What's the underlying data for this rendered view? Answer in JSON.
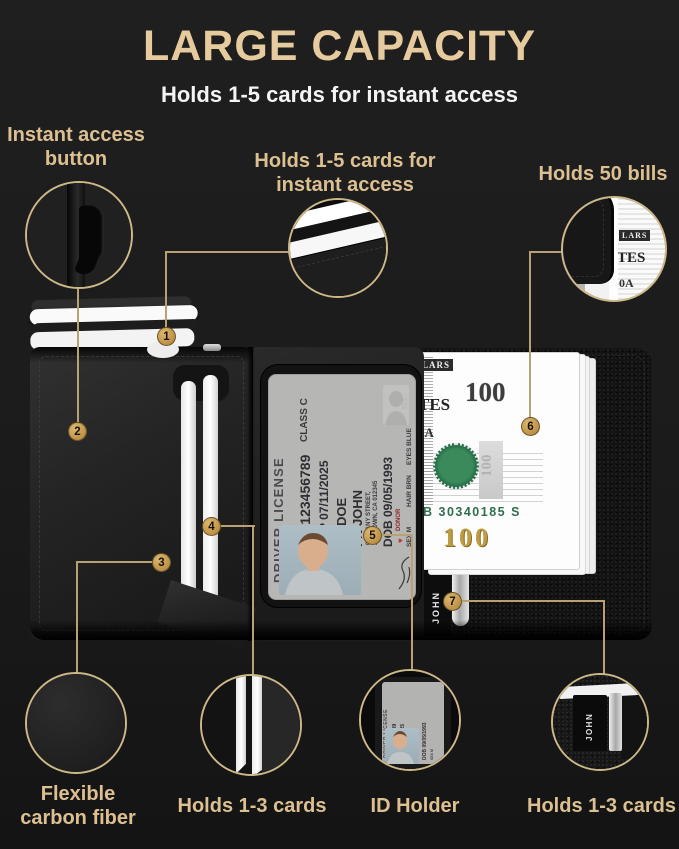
{
  "header": {
    "title": "LARGE CAPACITY",
    "subtitle": "Holds 1-5 cards for instant access"
  },
  "callouts": {
    "instant_access_button": {
      "badge": "2",
      "line1": "Instant access",
      "line2": "button"
    },
    "popup_cards": {
      "badge": "1",
      "line1": "Holds 1-5 cards for",
      "line2": "instant access"
    },
    "bill_pocket": {
      "badge": "6",
      "label": "Holds 50 bills"
    },
    "carbon_fiber": {
      "badge": "3",
      "line1": "Flexible",
      "line2": "carbon fiber"
    },
    "side_card_slot": {
      "badge": "4",
      "label": "Holds 1-3 cards"
    },
    "id_holder": {
      "badge": "5",
      "label": "ID Holder"
    },
    "back_card_slot": {
      "badge": "7",
      "label": "Holds 1-3 cards"
    }
  },
  "license": {
    "header": "DRIVER LICENSE",
    "class_field": "CLASS C",
    "dl_number": "DL 123456789",
    "exp": "EXP 07/11/2025",
    "last_name": "LN DOE",
    "first_name": "FN JOHN",
    "address1": "0123 ANY STREET,",
    "address2": "ANYTOWN, CA 012345",
    "dob": "DOB 09/05/1993",
    "sex": "SEX M",
    "hair": "HAIR BRN",
    "eyes": "EYES BLUE",
    "donor": "DONOR",
    "heart": "♥",
    "iss": "ISS"
  },
  "bill": {
    "denomination": "100",
    "serial": "B 30340185 S",
    "fragment1": "LARS",
    "fragment2": "TES",
    "fragment3": "0A"
  },
  "plate_name": "JOHN",
  "colors": {
    "background": "#1c1c1c",
    "gold_text": "#dcc091",
    "title_gold": "#e6cb9e",
    "badge_gold": "#c79f58",
    "line_gold": "#b9a172",
    "circle_border": "#cdb887",
    "serial_green": "#2f6e4f",
    "bill_gold": "#bf9b43"
  }
}
